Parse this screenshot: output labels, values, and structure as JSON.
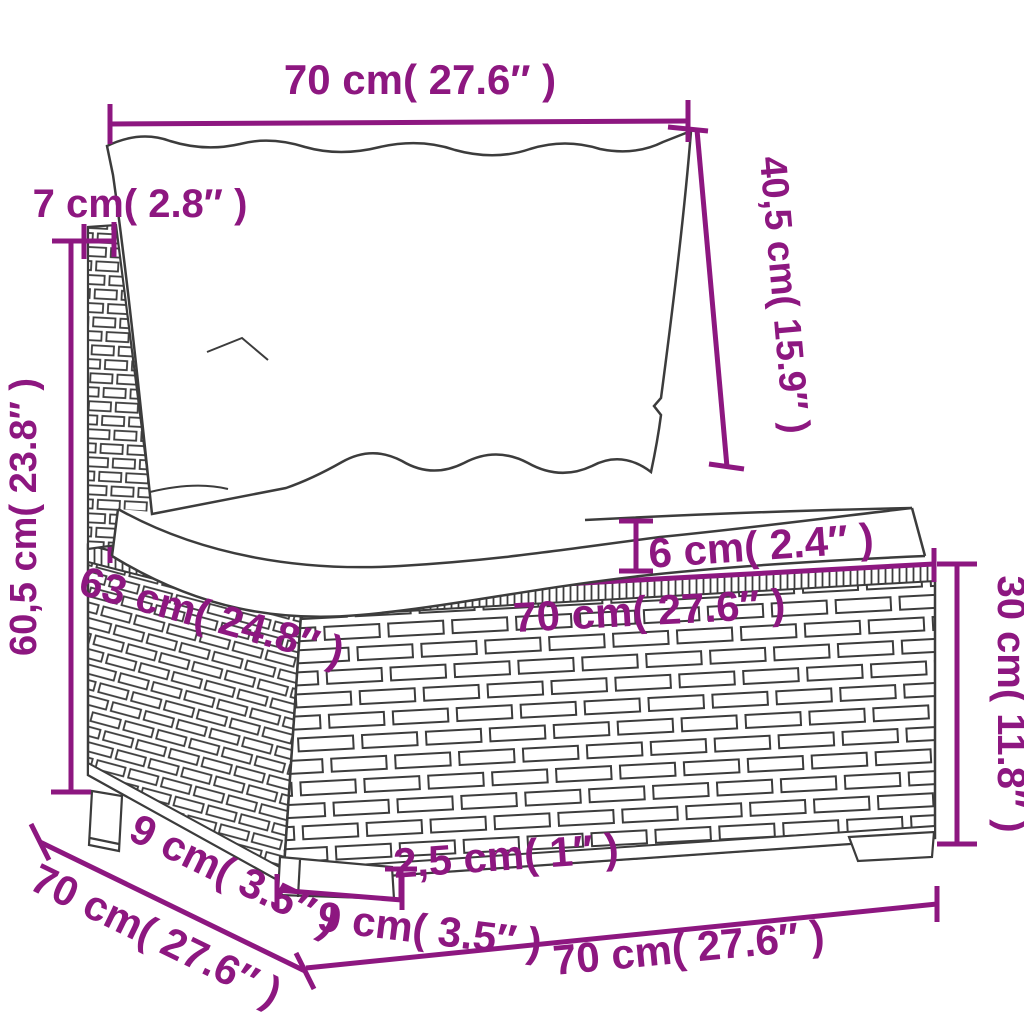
{
  "diagram": {
    "kind": "furniture-dimension-diagram",
    "subject": "poly rattan sofa middle section with back and seat cushions",
    "colors": {
      "dimension": "#8d1780",
      "sketch_line": "#3c3c3c",
      "background": "#ffffff"
    },
    "dimensions": {
      "top_width": "70 cm( 27.6″ )",
      "backrest_post_depth": "7 cm( 2.8″ )",
      "overall_height": "60,5 cm( 23.8″ )",
      "back_cushion_height": "40,5 cm( 15.9″ )",
      "seat_cushion_thickness": "6 cm( 2.4″ )",
      "seat_front_width": "70 cm( 27.6″ )",
      "seat_depth": "63 cm( 24.8″ )",
      "base_height": "30 cm( 11.8″ )",
      "rear_foot_size": "9 cm( 3.5″ )",
      "overall_depth": "70 cm( 27.6″ )",
      "front_foot_size": "9 cm( 3.5″ )",
      "foot_height": "2,5 cm( 1″ )",
      "bottom_width": "70 cm( 27.6″ )"
    }
  }
}
